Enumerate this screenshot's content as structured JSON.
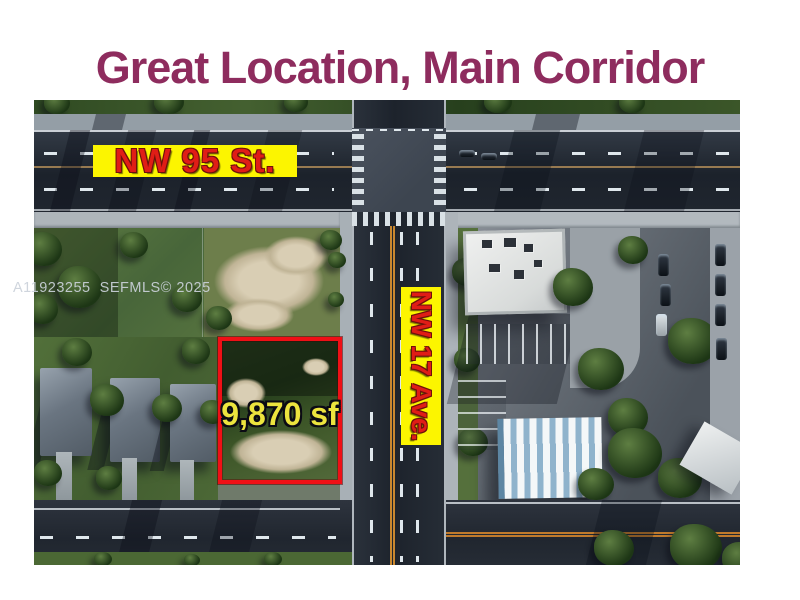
{
  "title": {
    "text": "Great Location, Main Corridor"
  },
  "photo": {
    "watermark": "A11923255  SEFMLS© 2025",
    "streets": {
      "horizontal": {
        "label": "NW 95 St."
      },
      "vertical": {
        "label": "NW 17 Ave."
      }
    },
    "property": {
      "size_label": "9,870 sf",
      "boundary_color": "#ef1016"
    }
  },
  "theme": {
    "title_color": "#8e2c5e",
    "street_label_bg": "#fcf500",
    "street_label_text": "#e01d16",
    "lot_size_text_color": "#ece43e"
  }
}
